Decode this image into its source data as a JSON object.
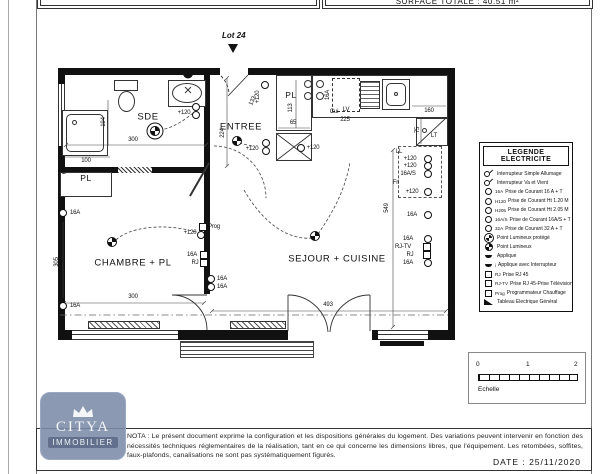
{
  "header": {
    "surface_label": "SURFACE TOTALE : 40.51 m²",
    "lot_label": "Lot 24"
  },
  "legend": {
    "title": "LEGENDE ELECTRICITE",
    "rows": [
      {
        "type": "switch",
        "tag": "",
        "label": "Interrupteur Simple Allumage"
      },
      {
        "type": "switch",
        "tag": "",
        "label": "Interrupteur Va et Vient"
      },
      {
        "type": "outlet",
        "tag": "16A",
        "label": "Prise de Courant 16 A + T"
      },
      {
        "type": "outlet",
        "tag": "H120",
        "label": "Prise de Courant Ht 1.20 M"
      },
      {
        "type": "outlet",
        "tag": "H205",
        "label": "Prise de Courant Ht 2.05 M"
      },
      {
        "type": "outlet",
        "tag": "16A/S",
        "label": "Prise de Courant 16A/S + T"
      },
      {
        "type": "outlet",
        "tag": "32A",
        "label": "Prise de Courant 32 A + T"
      },
      {
        "type": "lumprotege",
        "tag": "",
        "label": "Point Lumineux protégé"
      },
      {
        "type": "lum2",
        "tag": "",
        "label": "Point Lumineux"
      },
      {
        "type": "applique",
        "tag": "",
        "label": "Applique"
      },
      {
        "type": "applique",
        "tag": "i",
        "label": "Applique avec Interrupteur"
      },
      {
        "type": "rj",
        "tag": "RJ",
        "label": "Prise RJ 45"
      },
      {
        "type": "rj",
        "tag": "RJ-TV",
        "label": "Prise RJ 45-Prise Télévision"
      },
      {
        "type": "rj",
        "tag": "Prog",
        "label": "Programmateur Chauffage"
      },
      {
        "type": "tableau",
        "tag": "",
        "label": "Tableau Electrique Général"
      }
    ]
  },
  "plan": {
    "items": [
      {
        "type": "rm",
        "t": "SDE",
        "x": 148,
        "y": 117
      },
      {
        "type": "rm",
        "t": "ENTREE",
        "x": 241,
        "y": 127
      },
      {
        "type": "rs",
        "t": "PL",
        "x": 86,
        "y": 178
      },
      {
        "type": "rs",
        "t": "PL",
        "x": 291,
        "y": 95
      },
      {
        "type": "rm",
        "t": "CHAMBRE + PL",
        "x": 133,
        "y": 263
      },
      {
        "type": "rm",
        "t": "SEJOUR + CUISINE",
        "x": 337,
        "y": 259
      },
      {
        "type": "lab",
        "t": "300",
        "x": 133,
        "y": 140
      },
      {
        "type": "lab",
        "t": "194",
        "x": 104,
        "y": 122,
        "rot": -90
      },
      {
        "type": "lab",
        "t": "100",
        "x": 86,
        "y": 161
      },
      {
        "type": "lab",
        "t": "65",
        "x": 65,
        "y": 171,
        "rot": -90
      },
      {
        "type": "lab",
        "t": "224",
        "x": 223,
        "y": 133,
        "rot": -90
      },
      {
        "type": "lab",
        "t": "133",
        "x": 253,
        "y": 101,
        "rot": -65
      },
      {
        "type": "lab",
        "t": "113",
        "x": 291,
        "y": 108,
        "rot": -90
      },
      {
        "type": "lab",
        "t": "65",
        "x": 293,
        "y": 123
      },
      {
        "type": "lab",
        "t": "LV",
        "x": 346,
        "y": 110
      },
      {
        "type": "lab",
        "t": "225",
        "x": 345,
        "y": 120
      },
      {
        "type": "lab",
        "t": "160",
        "x": 429,
        "y": 111
      },
      {
        "type": "lab",
        "t": "75",
        "x": 418,
        "y": 130,
        "rot": -90
      },
      {
        "type": "lab",
        "t": "549",
        "x": 387,
        "y": 208,
        "rot": -90
      },
      {
        "type": "lab",
        "t": "493",
        "x": 328,
        "y": 305
      },
      {
        "type": "lab",
        "t": "300",
        "x": 133,
        "y": 297
      },
      {
        "type": "lab",
        "t": "305",
        "x": 57,
        "y": 262,
        "rot": -90
      },
      {
        "type": "lab",
        "t": "+120",
        "x": 184,
        "y": 113
      },
      {
        "type": "lab",
        "t": "+120",
        "x": 252,
        "y": 149
      },
      {
        "type": "lab",
        "t": "+120",
        "x": 258,
        "y": 97,
        "rot": -90
      },
      {
        "type": "lab",
        "t": "+120",
        "x": 313,
        "y": 148
      },
      {
        "type": "lab",
        "t": "+120",
        "x": 190,
        "y": 233
      },
      {
        "type": "lab",
        "t": "16A",
        "x": 75,
        "y": 213
      },
      {
        "type": "lab",
        "t": "16A",
        "x": 75,
        "y": 306
      },
      {
        "type": "lab",
        "t": "16A",
        "x": 192,
        "y": 255
      },
      {
        "type": "lab",
        "t": "RJ",
        "x": 195,
        "y": 263
      },
      {
        "type": "lab",
        "t": "Prog",
        "x": 214,
        "y": 227
      },
      {
        "type": "lab",
        "t": "16A",
        "x": 222,
        "y": 279
      },
      {
        "type": "lab",
        "t": "16A",
        "x": 222,
        "y": 287
      },
      {
        "type": "lab",
        "t": "LL",
        "x": 399,
        "y": 152
      },
      {
        "type": "lab",
        "t": "+120",
        "x": 410,
        "y": 159
      },
      {
        "type": "lab",
        "t": "+120",
        "x": 410,
        "y": 166
      },
      {
        "type": "lab",
        "t": "16A/S",
        "x": 408,
        "y": 174
      },
      {
        "type": "lab",
        "t": "Fri",
        "x": 396,
        "y": 183
      },
      {
        "type": "lab",
        "t": "+120",
        "x": 412,
        "y": 192
      },
      {
        "type": "lab",
        "t": "16A",
        "x": 412,
        "y": 215
      },
      {
        "type": "lab",
        "t": "16A",
        "x": 408,
        "y": 239
      },
      {
        "type": "lab",
        "t": "RJ-TV",
        "x": 403,
        "y": 247
      },
      {
        "type": "lab",
        "t": "RJ",
        "x": 410,
        "y": 255
      },
      {
        "type": "lab",
        "t": "16A",
        "x": 408,
        "y": 263
      },
      {
        "type": "lab",
        "t": "16A",
        "x": 328,
        "y": 95,
        "rot": -90
      },
      {
        "type": "lab",
        "t": "Cui",
        "x": 334,
        "y": 112
      },
      {
        "type": "lab",
        "t": "LT",
        "x": 434,
        "y": 136
      },
      {
        "type": "lup",
        "x": 155,
        "y": 131
      },
      {
        "type": "out",
        "x": 196,
        "y": 107
      },
      {
        "type": "out",
        "x": 196,
        "y": 115
      },
      {
        "type": "lum",
        "x": 237,
        "y": 141
      },
      {
        "type": "out",
        "x": 266,
        "y": 143
      },
      {
        "type": "out",
        "x": 266,
        "y": 151
      },
      {
        "type": "out",
        "x": 301,
        "y": 148
      },
      {
        "type": "out",
        "x": 265,
        "y": 85
      },
      {
        "type": "lum",
        "x": 112,
        "y": 242
      },
      {
        "type": "sq",
        "x": 203,
        "y": 227
      },
      {
        "type": "out",
        "x": 201,
        "y": 235
      },
      {
        "type": "sq",
        "x": 204,
        "y": 255
      },
      {
        "type": "sq",
        "x": 204,
        "y": 263
      },
      {
        "type": "out",
        "x": 211,
        "y": 279
      },
      {
        "type": "out",
        "x": 211,
        "y": 287
      },
      {
        "type": "lum",
        "x": 315,
        "y": 236
      },
      {
        "type": "out",
        "x": 428,
        "y": 159
      },
      {
        "type": "out",
        "x": 428,
        "y": 166
      },
      {
        "type": "out",
        "x": 428,
        "y": 174
      },
      {
        "type": "out",
        "x": 428,
        "y": 192
      },
      {
        "type": "out",
        "x": 428,
        "y": 215
      },
      {
        "type": "out",
        "x": 428,
        "y": 239
      },
      {
        "type": "sq",
        "x": 427,
        "y": 247
      },
      {
        "type": "sq",
        "x": 427,
        "y": 255
      },
      {
        "type": "out",
        "x": 428,
        "y": 263
      },
      {
        "type": "app",
        "x": 188,
        "y": 76
      },
      {
        "type": "out",
        "x": 63,
        "y": 213
      },
      {
        "type": "out",
        "x": 63,
        "y": 306
      }
    ]
  },
  "scale": {
    "ticks": [
      "0",
      "1",
      "2"
    ],
    "label": "Echelle"
  },
  "logo": {
    "name": "CITYA",
    "sub": "IMMOBILIER"
  },
  "footer": {
    "line1": "NOTA : Le présent document exprime la configuration et les dispositions générales du logement. Des variations peuvent intervenir en fonction des",
    "line2": "nécessités techniques réglementaires de la réalisation, tant en ce qui concerne les dimensions libres, que l'équipement. Les retombées, soffites,",
    "line3": "faux-plafonds, canalisations ne sont pas systématiquement figurés.",
    "date_label": "DATE : 25/11/2020"
  }
}
